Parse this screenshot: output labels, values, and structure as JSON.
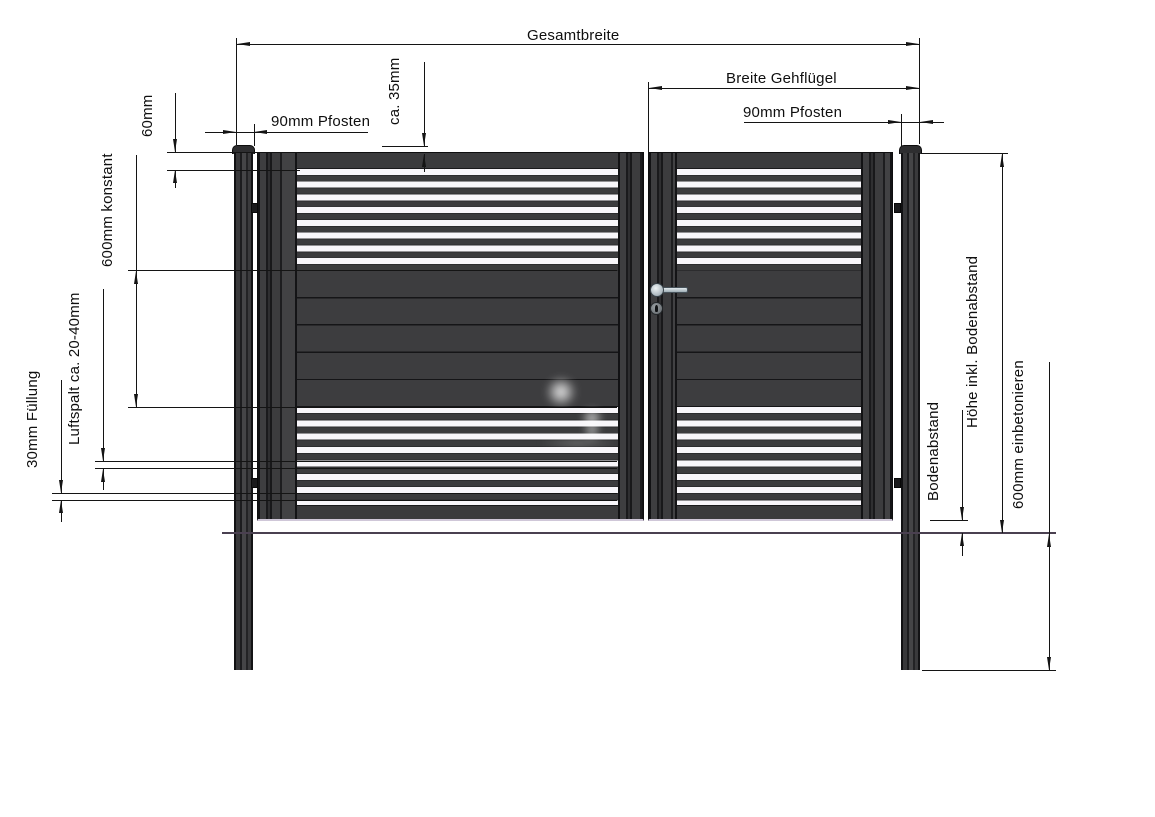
{
  "annotations": {
    "gesamtbreite": "Gesamtbreite",
    "breite_gehfluegel": "Breite Gehflügel",
    "pfosten_links": "90mm Pfosten",
    "pfosten_rechts": "90mm Pfosten",
    "ca_35mm": "ca. 35mm",
    "rail_60mm": "60mm",
    "konstant_600mm": "600mm konstant",
    "luftspalt": "Luftspalt ca. 20-40mm",
    "fuellung_30mm": "30mm Füllung",
    "hoehe": "Höhe inkl. Bodenabstand",
    "bodenabstand": "Bodenabstand",
    "einbetonieren_600mm": "600mm einbetonieren"
  },
  "colors": {
    "gate": "#3b3b3d",
    "slat_gap": "#f8f6fa",
    "drawing_line": "#141414",
    "ground_line": "#4a4050",
    "handle_silver": "#b7c2c8",
    "background": "#ffffff"
  }
}
